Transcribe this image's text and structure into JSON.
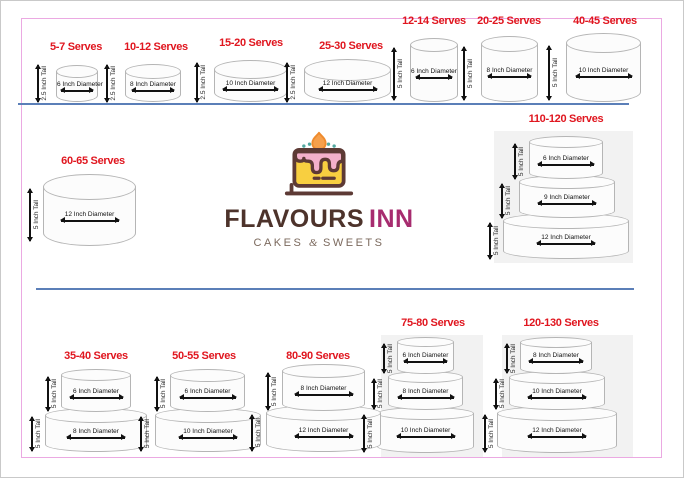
{
  "logo": {
    "brand_primary": "FLAVOURS",
    "brand_secondary": "INN",
    "tagline_cakes": "CAKES",
    "tagline_amp": "&",
    "tagline_sweets": "SWEETS"
  },
  "colors": {
    "title_red": "#e0161f",
    "divider_blue": "#5b7fb8",
    "frame_pink": "#eba9e2",
    "tier_outline": "#b5b5b5",
    "panel_gray": "#f2f2f2",
    "brand_brown": "#4d332b",
    "brand_magenta": "#a72c6f",
    "tagline_brown": "#7b695d",
    "icon_yellow": "#f8cf40",
    "icon_pink": "#f3b0ca",
    "icon_flame_orange": "#f6a04c",
    "icon_teal": "#53a8a0"
  },
  "cakes": {
    "c5_7": {
      "serves": "5-7 Serves",
      "tiers": [
        {
          "tall": "2.5 Inch Tall",
          "diameter": "6 Inch Diameter"
        }
      ]
    },
    "c10_12": {
      "serves": "10-12 Serves",
      "tiers": [
        {
          "tall": "2.5 Inch Tall",
          "diameter": "8 Inch Diameter"
        }
      ]
    },
    "c15_20": {
      "serves": "15-20 Serves",
      "tiers": [
        {
          "tall": "2.5 Inch Tall",
          "diameter": "10 Inch Diameter"
        }
      ]
    },
    "c25_30": {
      "serves": "25-30 Serves",
      "tiers": [
        {
          "tall": "2.5 Inch Tall",
          "diameter": "12 Inch Diameter"
        }
      ]
    },
    "c12_14": {
      "serves": "12-14 Serves",
      "tiers": [
        {
          "tall": "5 Inch Tall",
          "diameter": "6 Inch Diameter"
        }
      ]
    },
    "c20_25": {
      "serves": "20-25 Serves",
      "tiers": [
        {
          "tall": "5 Inch Tall",
          "diameter": "8 Inch Diameter"
        }
      ]
    },
    "c40_45": {
      "serves": "40-45 Serves",
      "tiers": [
        {
          "tall": "5 Inch Tall",
          "diameter": "10 Inch Diameter"
        }
      ]
    },
    "c60_65": {
      "serves": "60-65 Serves",
      "tiers": [
        {
          "tall": "5 Inch Tall",
          "diameter": "12 Inch Diameter"
        }
      ]
    },
    "c110_120": {
      "serves": "110-120 Serves",
      "tiers": [
        {
          "tall": "5 Inch Tall",
          "diameter": "6 Inch Diameter"
        },
        {
          "tall": "5 Inch Tall",
          "diameter": "9 Inch Diameter"
        },
        {
          "tall": "5 Inch Tall",
          "diameter": "12 Inch Diameter"
        }
      ]
    },
    "c35_40": {
      "serves": "35-40 Serves",
      "tiers": [
        {
          "tall": "5 Inch Tall",
          "diameter": "6 Inch Diameter"
        },
        {
          "tall": "5 Inch Tall",
          "diameter": "8 Inch Diameter"
        }
      ]
    },
    "c50_55": {
      "serves": "50-55 Serves",
      "tiers": [
        {
          "tall": "5 Inch Tall",
          "diameter": "6 Inch Diameter"
        },
        {
          "tall": "5 Inch Tall",
          "diameter": "10 Inch Diameter"
        }
      ]
    },
    "c80_90": {
      "serves": "80-90 Serves",
      "tiers": [
        {
          "tall": "5 Inch Tall",
          "diameter": "8 Inch Diameter"
        },
        {
          "tall": "5 Inch Tall",
          "diameter": "12 Inch Diameter"
        }
      ]
    },
    "c75_80": {
      "serves": "75-80 Serves",
      "tiers": [
        {
          "tall": "5 Inch Tall",
          "diameter": "6 Inch Diameter"
        },
        {
          "tall": "5 Inch Tall",
          "diameter": "8 Inch Diameter"
        },
        {
          "tall": "5 Inch Tall",
          "diameter": "10 Inch Diameter"
        }
      ]
    },
    "c120_130": {
      "serves": "120-130 Serves",
      "tiers": [
        {
          "tall": "5 Inch Tall",
          "diameter": "8 Inch Diameter"
        },
        {
          "tall": "5 Inch Tall",
          "diameter": "10 Inch Diameter"
        },
        {
          "tall": "5 Inch Tall",
          "diameter": "12 Inch Diameter"
        }
      ]
    }
  }
}
